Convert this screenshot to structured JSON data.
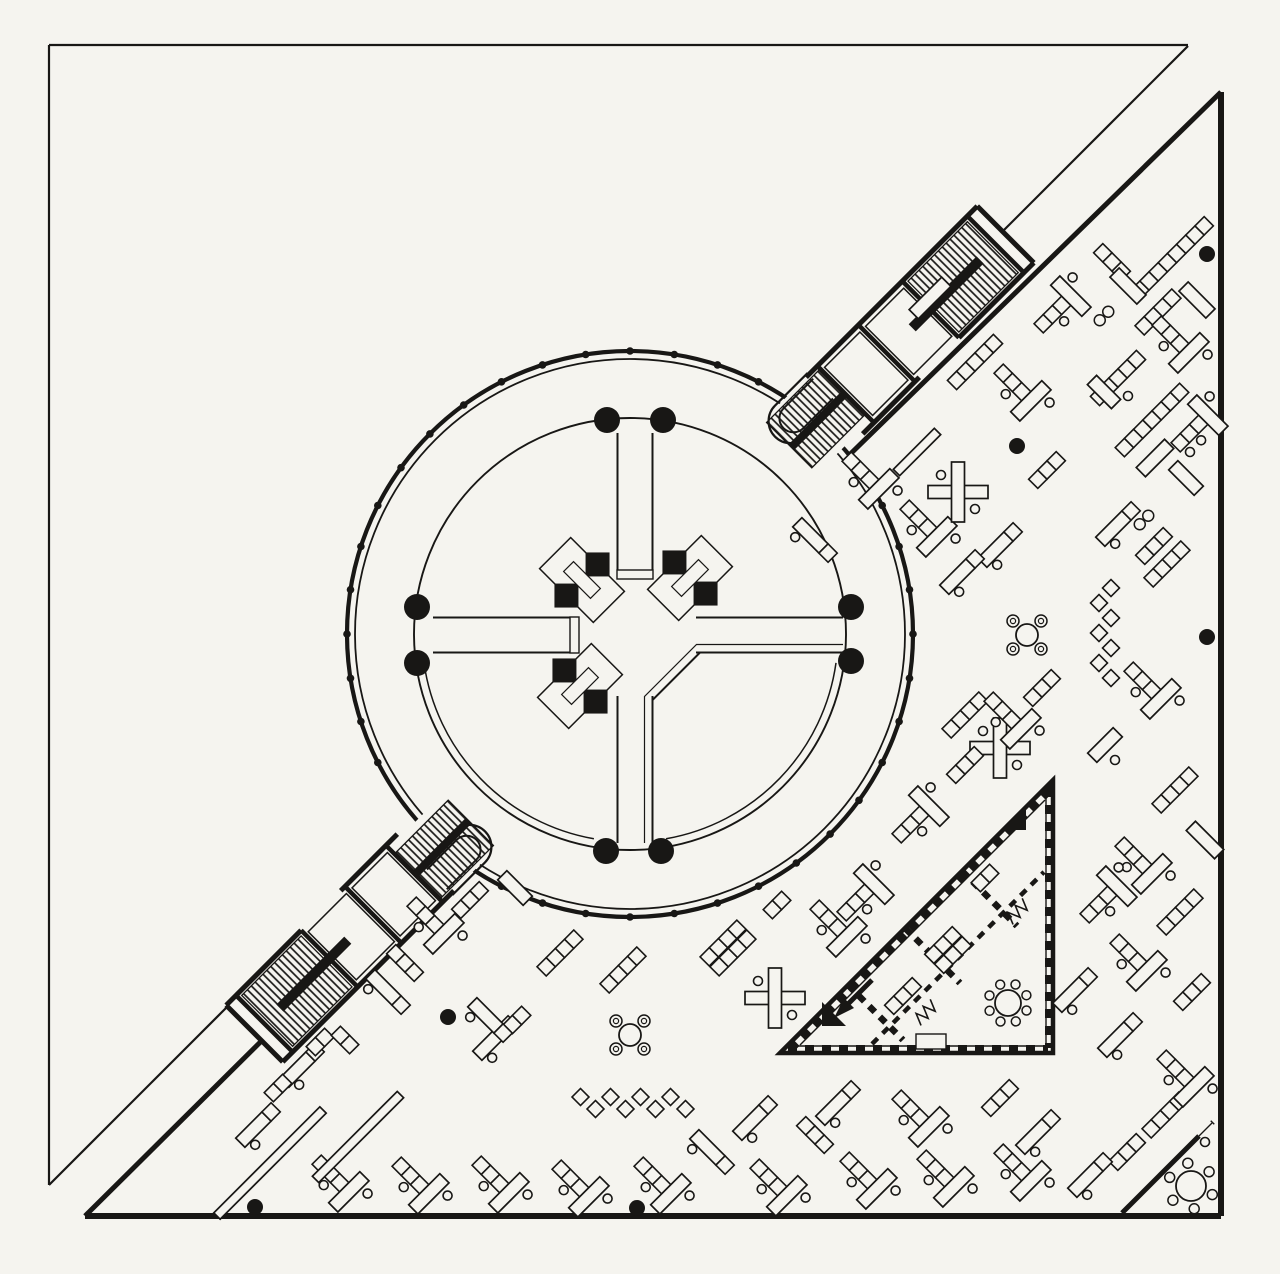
{
  "meta": {
    "kind": "architectural-floor-plan",
    "description": "black ink plan: triangular open office floor with central circular rotunda, two diagonal stair bridges, triangular meeting suite and scattered 45-degree desk groups"
  },
  "palette": {
    "paper": "#f5f4ef",
    "ink": "#181715"
  },
  "plan": {
    "canvas": {
      "w": 1280,
      "h": 1274
    },
    "site_triangle": {
      "corner": [
        49,
        45
      ],
      "top_right": [
        1188,
        45
      ],
      "bottom_left": [
        49,
        1185
      ],
      "diag_segments": [
        [
          [
            1188,
            46
          ],
          [
            1000,
            234
          ]
        ],
        [
          [
            232,
            1002
          ],
          [
            49,
            1185
          ]
        ]
      ]
    },
    "building_triangle": {
      "right_top": [
        1221,
        92
      ],
      "right_bottom": [
        1221,
        1216
      ],
      "left_bottom": [
        85,
        1216
      ],
      "hyp_segments": [
        [
          [
            1221,
            92
          ],
          [
            836,
            468
          ]
        ],
        [
          [
            458,
            846
          ],
          [
            85,
            1216
          ]
        ]
      ]
    },
    "rotunda": {
      "cx": 630,
      "cy": 634,
      "outer_r": 283,
      "ring_r": 275,
      "inner_r": 216,
      "inner_wall_r": 208,
      "mullion_step_deg": 9,
      "mullion_r": 3.8,
      "mullion_skip": [
        [
          298,
          332
        ],
        [
          118,
          152
        ]
      ],
      "columns": [
        [
          607,
          420
        ],
        [
          663,
          420
        ],
        [
          417,
          607
        ],
        [
          417,
          663
        ],
        [
          606,
          851
        ],
        [
          661,
          851
        ],
        [
          851,
          607
        ],
        [
          851,
          661
        ]
      ],
      "column_r": 13,
      "corridor": {
        "w1": 617.5,
        "w2": 652.5,
        "inner_end": 570,
        "outer_start": 696,
        "outer_end": 843,
        "top_start": 433
      },
      "core_clusters": [
        {
          "x": 582,
          "y": 580,
          "r": 45
        },
        {
          "x": 690,
          "y": 578,
          "r": -45
        },
        {
          "x": 580,
          "y": 686,
          "r": -45
        }
      ]
    },
    "bridges": [
      {
        "x": 792,
        "y": 448,
        "angle": -45
      },
      {
        "x": 468,
        "y": 820,
        "angle": 135
      }
    ],
    "triangle_suite": {
      "vertices": [
        [
          780,
          1053
        ],
        [
          1053,
          780
        ],
        [
          1053,
          1053
        ]
      ],
      "partitions": [
        [
          [
            848,
            985
          ],
          [
            903,
            1040
          ]
        ],
        [
          [
            905,
            928
          ],
          [
            960,
            983
          ]
        ],
        [
          [
            962,
            871
          ],
          [
            1017,
            926
          ]
        ]
      ],
      "corridor_wall": [
        [
          872,
          1044
        ],
        [
          1044,
          872
        ]
      ],
      "wedges": [
        {
          "pts": "822,1002 846,1026 822,1026"
        },
        {
          "pts": "1002,830 1026,806 1026,830"
        },
        {
          "pts": "1041,792 1053,780 1053,792"
        }
      ],
      "arrow": {
        "from": [
          872,
          980
        ],
        "to": [
          842,
          1010
        ]
      },
      "vestibule": {
        "x": 916,
        "y": 1034,
        "w": 30,
        "h": 15
      }
    },
    "corner_room": {
      "wall": [
        [
          1122,
          1213
        ],
        [
          1213,
          1122
        ]
      ],
      "door_gap": [
        [
          1199,
          1136
        ],
        [
          1212,
          1123
        ]
      ]
    },
    "furniture": [
      {
        "t": "chain",
        "n": 8,
        "x": 1172,
        "y": 258,
        "r": -45
      },
      {
        "t": "chain",
        "n": 3,
        "x": 1112,
        "y": 262,
        "r": 45
      },
      {
        "t": "rect",
        "len": 38,
        "x": 1128,
        "y": 286,
        "r": 45
      },
      {
        "t": "desk1",
        "x": 1062,
        "y": 305,
        "r": -45
      },
      {
        "t": "rect",
        "len": 46,
        "x": 930,
        "y": 298,
        "r": -45
      },
      {
        "t": "ring8",
        "x": 1104,
        "y": 316,
        "r": -45
      },
      {
        "t": "chain",
        "n": 4,
        "x": 1158,
        "y": 312,
        "r": -45
      },
      {
        "t": "rect",
        "len": 38,
        "x": 1197,
        "y": 300,
        "r": 45
      },
      {
        "t": "desk1",
        "x": 1180,
        "y": 344,
        "r": 45
      },
      {
        "t": "chain",
        "n": 5,
        "x": 975,
        "y": 362,
        "r": -45
      },
      {
        "t": "desk1",
        "x": 1022,
        "y": 392,
        "r": 45
      },
      {
        "t": "chain",
        "n": 5,
        "x": 1118,
        "y": 378,
        "r": -45
      },
      {
        "t": "rect",
        "len": 34,
        "x": 1104,
        "y": 392,
        "r": 45
      },
      {
        "t": "chair",
        "x": 1128,
        "y": 396,
        "r": 0
      },
      {
        "t": "chain",
        "n": 7,
        "x": 1152,
        "y": 420,
        "r": -45
      },
      {
        "t": "desk1",
        "x": 1199,
        "y": 424,
        "r": -45
      },
      {
        "t": "rect",
        "len": 40,
        "x": 1155,
        "y": 458,
        "r": -45
      },
      {
        "t": "rect",
        "len": 36,
        "x": 1186,
        "y": 478,
        "r": 45
      },
      {
        "t": "chair",
        "x": 1190,
        "y": 452,
        "r": 0
      },
      {
        "t": "chain",
        "n": 3,
        "x": 1047,
        "y": 470,
        "r": -45
      },
      {
        "t": "desk2",
        "x": 1118,
        "y": 524,
        "r": -45
      },
      {
        "t": "ring8",
        "x": 1144,
        "y": 520,
        "r": -45
      },
      {
        "t": "chain",
        "n": 3,
        "x": 1154,
        "y": 546,
        "r": -45
      },
      {
        "t": "chain",
        "n": 4,
        "x": 1167,
        "y": 564,
        "r": -45
      },
      {
        "t": "bar",
        "len": 58,
        "x": 917,
        "y": 452,
        "r": -45
      },
      {
        "t": "desk1",
        "x": 870,
        "y": 480,
        "r": 45
      },
      {
        "t": "desk2",
        "x": 815,
        "y": 540,
        "r": 45
      },
      {
        "t": "desk1",
        "x": 928,
        "y": 528,
        "r": 45
      },
      {
        "t": "plus",
        "x": 958,
        "y": 492,
        "r": 0
      },
      {
        "t": "desk2",
        "x": 1000,
        "y": 545,
        "r": -45
      },
      {
        "t": "desk2",
        "x": 962,
        "y": 572,
        "r": -45
      },
      {
        "t": "table4",
        "x": 1027,
        "y": 635,
        "r": 0
      },
      {
        "t": "zigzag",
        "n": 7,
        "x": 1105,
        "y": 633,
        "r": 90
      },
      {
        "t": "dot",
        "x": 1207,
        "y": 254,
        "r": 0
      },
      {
        "t": "dot",
        "x": 1017,
        "y": 446,
        "r": 0
      },
      {
        "t": "dot",
        "x": 1207,
        "y": 637,
        "r": 0
      },
      {
        "t": "dot",
        "x": 448,
        "y": 1017,
        "r": 0
      },
      {
        "t": "dot",
        "x": 255,
        "y": 1207,
        "r": 0
      },
      {
        "t": "dot",
        "x": 637,
        "y": 1208,
        "r": 0
      },
      {
        "t": "desk1",
        "x": 1152,
        "y": 690,
        "r": 45
      },
      {
        "t": "chain",
        "n": 4,
        "x": 965,
        "y": 715,
        "r": -45
      },
      {
        "t": "plus",
        "x": 1000,
        "y": 748,
        "r": 0
      },
      {
        "t": "rect",
        "len": 36,
        "x": 1105,
        "y": 745,
        "r": -45
      },
      {
        "t": "chair",
        "x": 1115,
        "y": 760,
        "r": 0
      },
      {
        "t": "chain",
        "n": 4,
        "x": 1175,
        "y": 790,
        "r": -45
      },
      {
        "t": "desk1",
        "x": 1143,
        "y": 865,
        "r": 45
      },
      {
        "t": "rect",
        "len": 40,
        "x": 1205,
        "y": 840,
        "r": 45
      },
      {
        "t": "desk1",
        "x": 1108,
        "y": 895,
        "r": -45
      },
      {
        "t": "chain",
        "n": 4,
        "x": 1180,
        "y": 912,
        "r": -45
      },
      {
        "t": "desk1",
        "x": 1138,
        "y": 962,
        "r": 45
      },
      {
        "t": "chain",
        "n": 3,
        "x": 1192,
        "y": 992,
        "r": -45
      },
      {
        "t": "desk2",
        "x": 1075,
        "y": 990,
        "r": -45
      },
      {
        "t": "desk2",
        "x": 1120,
        "y": 1035,
        "r": -45
      },
      {
        "t": "chain",
        "n": 4,
        "x": 1165,
        "y": 1115,
        "r": -45
      },
      {
        "t": "chain",
        "n": 3,
        "x": 1127,
        "y": 1152,
        "r": -45
      },
      {
        "t": "desk1",
        "x": 1185,
        "y": 1078,
        "r": 45
      },
      {
        "t": "desk2",
        "x": 1090,
        "y": 1175,
        "r": -45
      },
      {
        "t": "chair",
        "x": 1205,
        "y": 1142,
        "r": 0
      },
      {
        "t": "table6",
        "x": 1191,
        "y": 1186,
        "r": 0
      },
      {
        "t": "dblchain",
        "n": 4,
        "x": 728,
        "y": 948,
        "r": -45
      },
      {
        "t": "plus",
        "x": 775,
        "y": 998,
        "r": 0
      },
      {
        "t": "chain",
        "n": 2,
        "x": 777,
        "y": 905,
        "r": -45
      },
      {
        "t": "desk1",
        "x": 838,
        "y": 928,
        "r": 45
      },
      {
        "t": "desk1",
        "x": 865,
        "y": 893,
        "r": -45
      },
      {
        "t": "desk1",
        "x": 920,
        "y": 815,
        "r": -45
      },
      {
        "t": "chain",
        "n": 3,
        "x": 965,
        "y": 765,
        "r": -45
      },
      {
        "t": "desk1",
        "x": 1012,
        "y": 720,
        "r": 45
      },
      {
        "t": "chain",
        "n": 3,
        "x": 1042,
        "y": 688,
        "r": -45
      },
      {
        "t": "table4",
        "x": 630,
        "y": 1035,
        "r": 0
      },
      {
        "t": "zigzag",
        "n": 8,
        "x": 633,
        "y": 1103,
        "r": 0
      },
      {
        "t": "desk2",
        "x": 495,
        "y": 1038,
        "r": -45
      },
      {
        "t": "chain",
        "n": 2,
        "x": 517,
        "y": 1020,
        "r": -45
      },
      {
        "t": "desk2",
        "x": 755,
        "y": 1118,
        "r": -45
      },
      {
        "t": "chain",
        "n": 3,
        "x": 815,
        "y": 1135,
        "r": 45
      },
      {
        "t": "desk2",
        "x": 838,
        "y": 1103,
        "r": -45
      },
      {
        "t": "desk2",
        "x": 712,
        "y": 1152,
        "r": 45
      },
      {
        "t": "desk1",
        "x": 340,
        "y": 1183,
        "r": 45
      },
      {
        "t": "desk1",
        "x": 420,
        "y": 1185,
        "r": 45
      },
      {
        "t": "desk1",
        "x": 500,
        "y": 1184,
        "r": 45
      },
      {
        "t": "desk1",
        "x": 580,
        "y": 1188,
        "r": 45
      },
      {
        "t": "desk1",
        "x": 662,
        "y": 1185,
        "r": 45
      },
      {
        "t": "desk1",
        "x": 778,
        "y": 1187,
        "r": 45
      },
      {
        "t": "desk1",
        "x": 868,
        "y": 1180,
        "r": 45
      },
      {
        "t": "desk1",
        "x": 945,
        "y": 1178,
        "r": 45
      },
      {
        "t": "desk1",
        "x": 1022,
        "y": 1172,
        "r": 45
      },
      {
        "t": "desk1",
        "x": 920,
        "y": 1118,
        "r": 45
      },
      {
        "t": "chain",
        "n": 3,
        "x": 1000,
        "y": 1098,
        "r": -45
      },
      {
        "t": "desk2",
        "x": 1038,
        "y": 1132,
        "r": -45
      },
      {
        "t": "bar",
        "len": 150,
        "x": 270,
        "y": 1163,
        "r": -45
      },
      {
        "t": "bar",
        "len": 120,
        "x": 358,
        "y": 1137,
        "r": -45
      },
      {
        "t": "desk2",
        "x": 302,
        "y": 1065,
        "r": -45
      },
      {
        "t": "chain",
        "n": 2,
        "x": 278,
        "y": 1088,
        "r": -45
      },
      {
        "t": "desk2",
        "x": 258,
        "y": 1125,
        "r": -45
      },
      {
        "t": "chain",
        "n": 2,
        "x": 320,
        "y": 1042,
        "r": -45
      },
      {
        "t": "desk1",
        "x": 435,
        "y": 925,
        "r": 45
      },
      {
        "t": "chain",
        "n": 3,
        "x": 470,
        "y": 900,
        "r": -45
      },
      {
        "t": "rect",
        "len": 36,
        "x": 515,
        "y": 888,
        "r": 45
      },
      {
        "t": "chain",
        "n": 3,
        "x": 405,
        "y": 963,
        "r": 45
      },
      {
        "t": "desk2",
        "x": 388,
        "y": 992,
        "r": 45
      },
      {
        "t": "chain",
        "n": 4,
        "x": 560,
        "y": 953,
        "r": -45
      },
      {
        "t": "chain",
        "n": 4,
        "x": 623,
        "y": 970,
        "r": -45
      },
      {
        "t": "desk2",
        "x": 490,
        "y": 1020,
        "r": 45
      },
      {
        "t": "chain",
        "n": 2,
        "x": 345,
        "y": 1040,
        "r": 45
      },
      {
        "t": "dblchain",
        "n": 3,
        "x": 948,
        "y": 950,
        "r": -45
      },
      {
        "t": "chain",
        "n": 3,
        "x": 903,
        "y": 996,
        "r": -45
      },
      {
        "t": "wglyph",
        "x": 1018,
        "y": 911,
        "r": -45
      },
      {
        "t": "wglyph",
        "x": 926,
        "y": 1012,
        "r": -45
      },
      {
        "t": "chain",
        "n": 2,
        "x": 985,
        "y": 878,
        "r": -45
      },
      {
        "t": "table8",
        "x": 1008,
        "y": 1003,
        "r": 0
      }
    ]
  }
}
